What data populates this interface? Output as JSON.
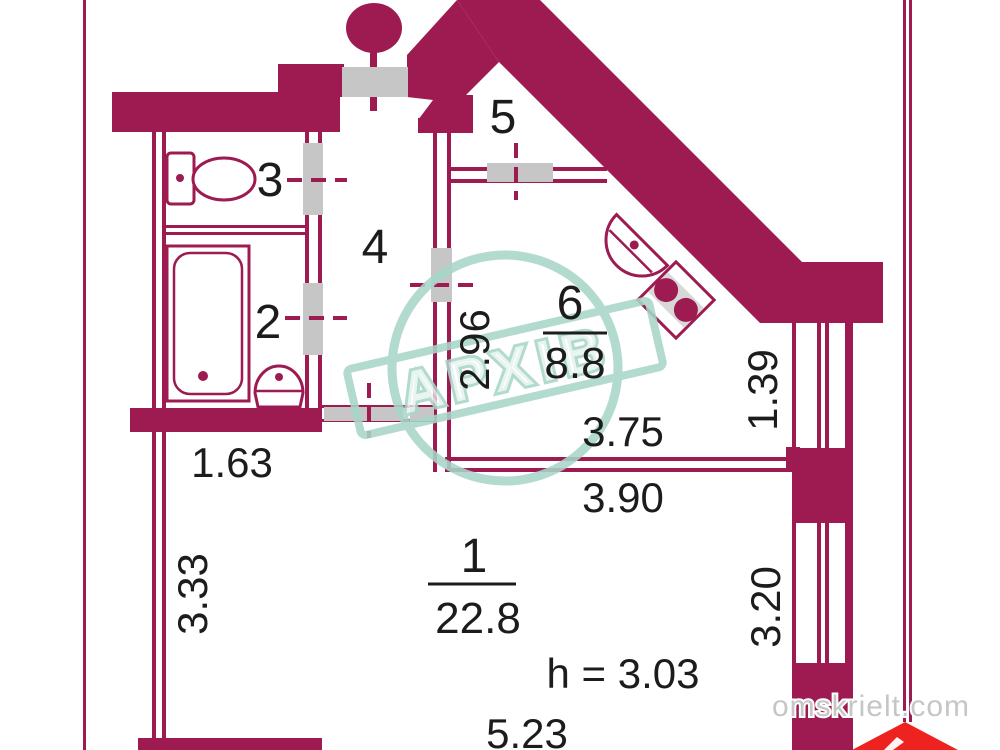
{
  "title": "Apartment floor plan",
  "colors": {
    "wall": "#9e1b51",
    "opening_gray": "#c6c6c6",
    "fixture_gray": "#d8d8d8",
    "stamp_teal": "#a8d6c9",
    "logo_red": "#ee2320",
    "watermark_gray": "#c6c6c6",
    "text_black": "#1c1c1c"
  },
  "rooms": {
    "room1": {
      "number": "1",
      "area": "22.8"
    },
    "room2": {
      "number": "2"
    },
    "room3": {
      "number": "3"
    },
    "room4": {
      "number": "4"
    },
    "room5": {
      "number": "5"
    },
    "room6": {
      "number": "6",
      "area": "8.8"
    }
  },
  "dimensions": {
    "w163": "1.63",
    "h333": "3.33",
    "h296": "2.96",
    "w375": "3.75",
    "w390": "3.90",
    "h139": "1.39",
    "h320": "3.20",
    "w523": "5.23",
    "ceiling": "h = 3.03"
  },
  "stamp": {
    "text": "АРХІВ"
  },
  "watermark": {
    "site": "omskrielt.com"
  }
}
